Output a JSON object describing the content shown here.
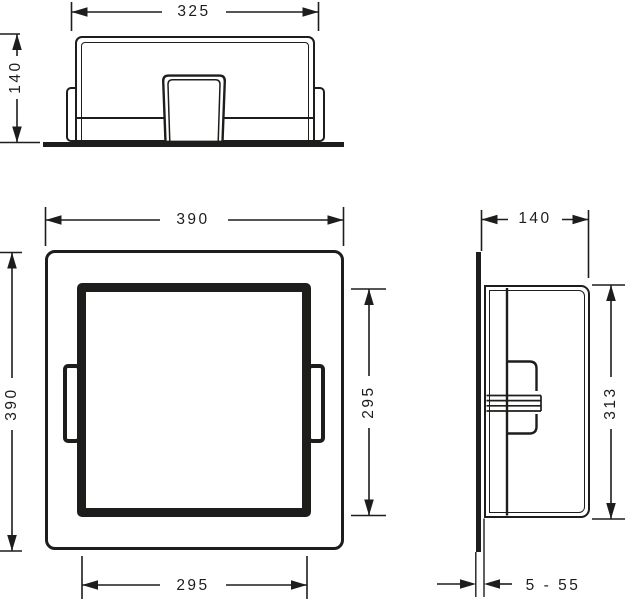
{
  "drawing": {
    "line_color": "#1d1d1b",
    "dims": {
      "top_width": "325",
      "top_height": "140",
      "front_width": "390",
      "front_height": "390",
      "front_opening_width": "295",
      "front_opening_height": "295",
      "side_depth": "140",
      "side_height": "313",
      "side_tile_range": "5 - 55"
    }
  }
}
